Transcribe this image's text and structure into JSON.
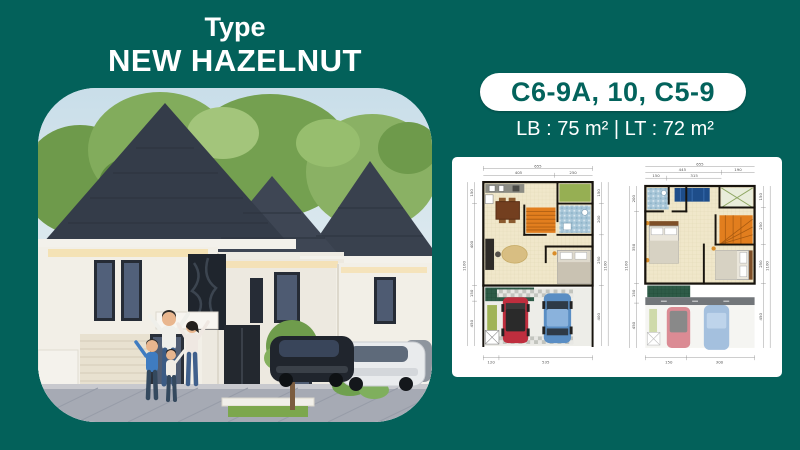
{
  "page": {
    "background_color": "#03615A"
  },
  "title": {
    "line1": "Type",
    "line2": "NEW HAZELNUT"
  },
  "unit_badge": {
    "label": "C6-9A, 10, C5-9",
    "text_color": "#03635C",
    "background_color": "#FFFFFF"
  },
  "area_info": {
    "label": "LB : 75 m² | LT : 72 m²"
  },
  "render": {
    "roof_color": "#39414E",
    "wall_color": "#F2EFE7",
    "sky_color": "#CFE2EA",
    "tree_color": "#7CA457",
    "eave_light_color": "#F5DFAC",
    "stairs_color": "#E27E1E"
  },
  "floor_plans": {
    "ground": {
      "dims": {
        "top_total": "655",
        "top_a": "405",
        "top_b": "250",
        "bottom_a": "120",
        "bottom_b": "535",
        "left_total": "1100",
        "left_a": "150",
        "left_b": "400",
        "left_c": "150",
        "left_d": "450",
        "right_total": "1100",
        "right_a": "150",
        "right_b": "200",
        "right_c": "250",
        "right_d": "400"
      }
    },
    "upper": {
      "dims": {
        "top_total": "655",
        "top_a": "445",
        "top_b": "190",
        "top_c": "150",
        "top_d": "315",
        "bottom_a": "150",
        "bottom_b": "300",
        "left_total": "1100",
        "left_a": "200",
        "left_b": "350",
        "left_c": "150",
        "left_d": "450",
        "right_total": "1100",
        "right_a": "150",
        "right_b": "250",
        "right_c": "250",
        "right_d": "450"
      }
    }
  }
}
